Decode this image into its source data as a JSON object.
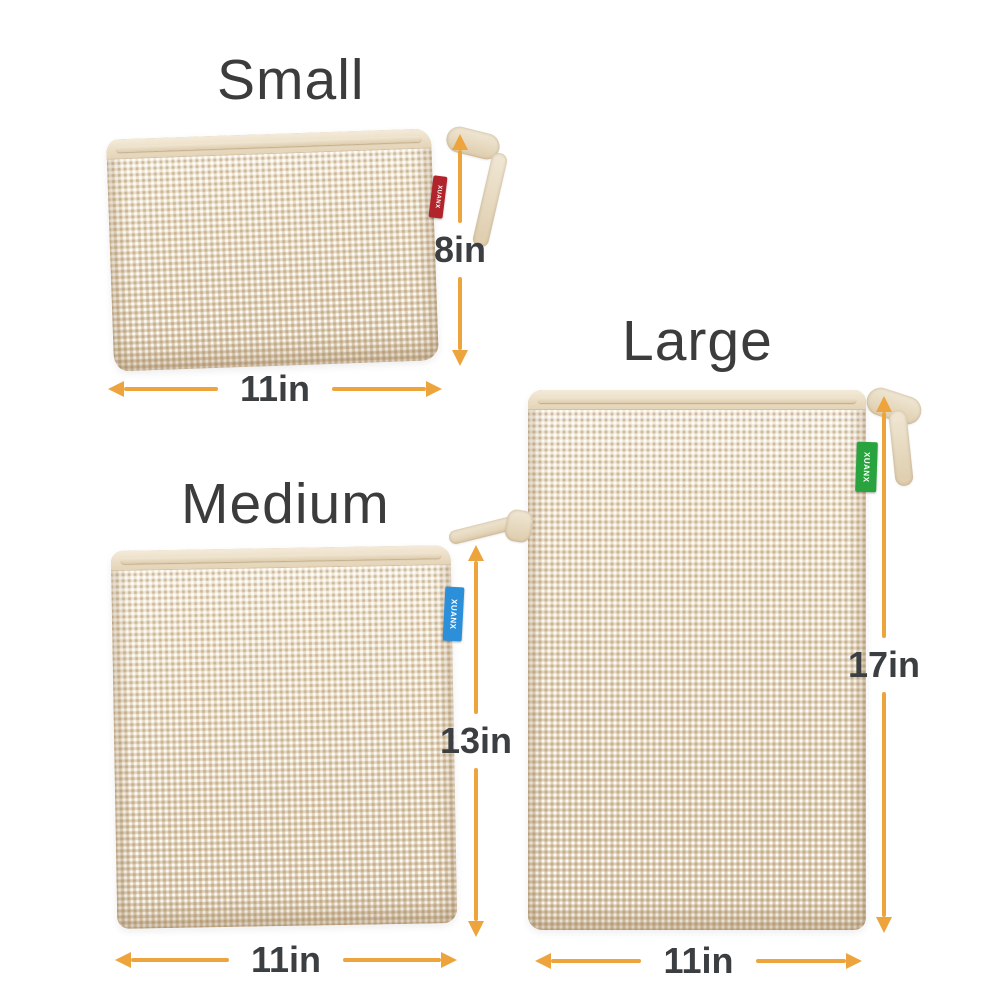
{
  "page": {
    "background": "#ffffff",
    "description": "Product size chart showing three cotton mesh drawstring produce bags with dimension arrows"
  },
  "colors": {
    "arrow": "#EDA43D",
    "title_text": "#3C3C3C",
    "dimension_text": "#3B3F42",
    "bag_fabric": "#ECE0CA",
    "rope": "#E6D8BD",
    "tag_small": "#B2242B",
    "tag_medium": "#2B8FD9",
    "tag_large": "#29A33E"
  },
  "bags": [
    {
      "size": "small",
      "title": "Small",
      "height_label": "8in",
      "width_label": "11in",
      "tag_text": "XUANX",
      "tag_color": "#B2242B"
    },
    {
      "size": "medium",
      "title": "Medium",
      "height_label": "13in",
      "width_label": "11in",
      "tag_text": "XUANX",
      "tag_color": "#2B8FD9"
    },
    {
      "size": "large",
      "title": "Large",
      "height_label": "17in",
      "width_label": "11in",
      "tag_text": "XUANX",
      "tag_color": "#29A33E"
    }
  ]
}
